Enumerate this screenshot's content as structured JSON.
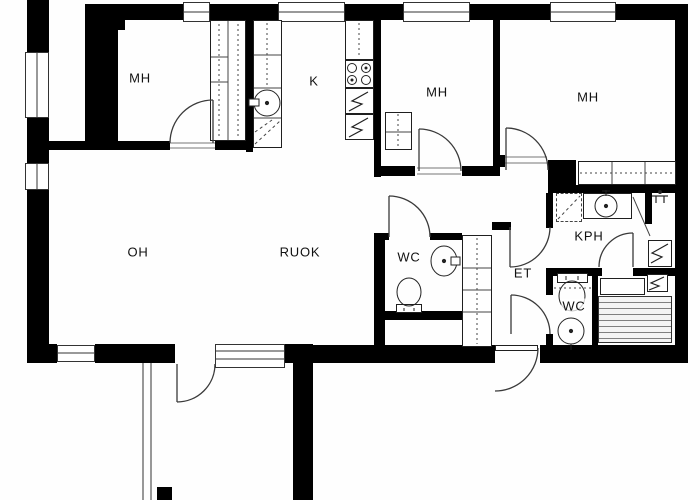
{
  "plan": {
    "bg_color": "#ffffff",
    "wall_color": "#000000",
    "line_color": "#1f1f1f",
    "rooms": [
      {
        "id": "bedroom-1",
        "label": "MH"
      },
      {
        "id": "kitchen",
        "label": "K"
      },
      {
        "id": "bedroom-2",
        "label": "MH"
      },
      {
        "id": "bedroom-3",
        "label": "MH"
      },
      {
        "id": "living-room",
        "label": "OH"
      },
      {
        "id": "dining",
        "label": "RUOK"
      },
      {
        "id": "toilet-1",
        "label": "WC"
      },
      {
        "id": "hallway",
        "label": "ET"
      },
      {
        "id": "bathroom",
        "label": "KPH"
      },
      {
        "id": "toilet-2",
        "label": "WC"
      }
    ],
    "fixtures": [
      "kitchen-sink",
      "stove",
      "fridge",
      "freezer",
      "wardrobes",
      "bathroom-sink",
      "toilet",
      "shower",
      "washing-machine-space",
      "water-heater",
      "sauna-stove",
      "sauna-benches",
      "windows",
      "doors",
      "balcony"
    ]
  }
}
